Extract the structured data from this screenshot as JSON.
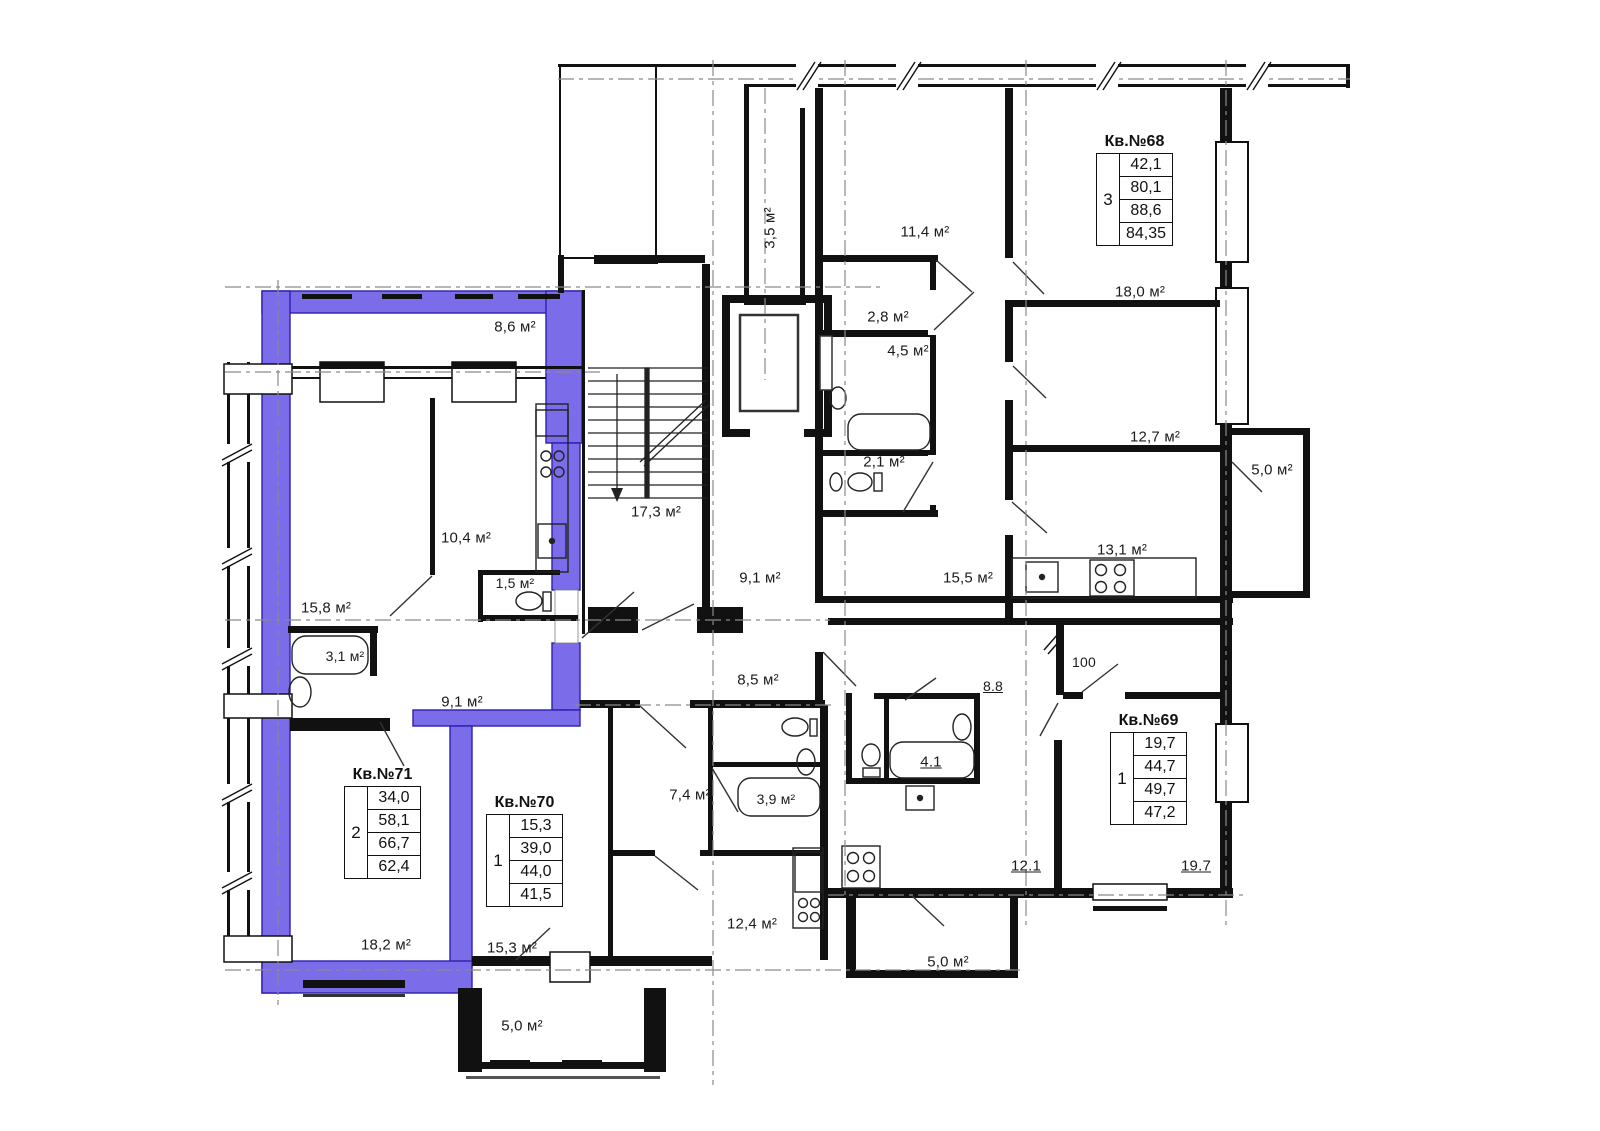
{
  "plan": {
    "highlight_color": "#7b6ce9",
    "labels": {
      "balcony_86": "8,6 м²",
      "loggia_35": "3,5 м²",
      "room_114": "11,4 м²",
      "hall_28": "2,8 м²",
      "bath_45": "4,5 м²",
      "room_180": "18,0 м²",
      "room_127": "12,7 м²",
      "balcony_50_right": "5,0 м²",
      "wc_21": "2,1 м²",
      "kitchen_131": "13,1 м²",
      "room_155": "15,5 м²",
      "corridor_91": "9,1 м²",
      "stair_173": "17,3 м²",
      "kitchen_104": "10,4 м²",
      "wc_15": "1,5 м²",
      "room_158": "15,8 м²",
      "bath_31": "3,1 м²",
      "hall_91": "9,1 м²",
      "hall_85": "8,5 м²",
      "hall_88": "8.8",
      "dim_100": "100",
      "bath_41": "4.1",
      "bath_39": "3,9 м²",
      "hall_74": "7,4 м²",
      "room_121": "12.1",
      "room_197": "19.7",
      "room_182": "18,2 м²",
      "room_153": "15,3 м²",
      "kitchen_124": "12,4 м²",
      "balcony_50_mid": "5,0 м²",
      "balcony_50_bottom": "5,0 м²"
    },
    "apartments": {
      "apt68": {
        "title": "Кв.№68",
        "rooms": "3",
        "values": [
          "42,1",
          "80,1",
          "88,6",
          "84,35"
        ]
      },
      "apt69": {
        "title": "Кв.№69",
        "rooms": "1",
        "values": [
          "19,7",
          "44,7",
          "49,7",
          "47,2"
        ]
      },
      "apt70": {
        "title": "Кв.№70",
        "rooms": "1",
        "values": [
          "15,3",
          "39,0",
          "44,0",
          "41,5"
        ]
      },
      "apt71": {
        "title": "Кв.№71",
        "rooms": "2",
        "values": [
          "34,0",
          "58,1",
          "66,7",
          "62,4"
        ]
      }
    }
  }
}
